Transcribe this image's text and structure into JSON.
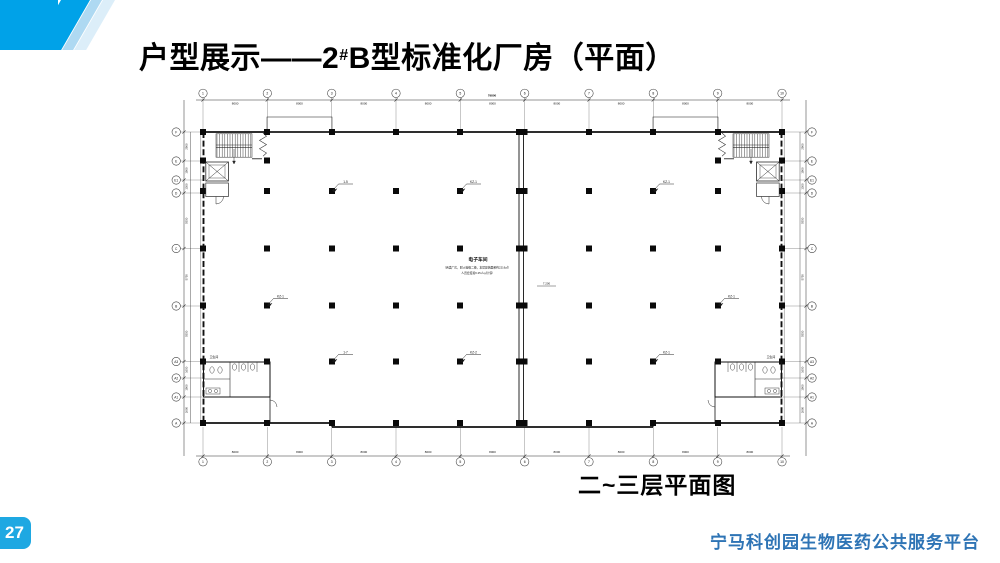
{
  "slide": {
    "title_prefix": "户型展示——2",
    "title_hash": "#",
    "title_suffix": "B型标准化厂房（平面）"
  },
  "caption": "二~三层平面图",
  "footer": {
    "text": "宁马科创园生物医药公共服务平台",
    "page": "27"
  },
  "colors": {
    "header_blue": "#00A2E8",
    "stripe_light": "#AED9F2",
    "stripe_pale": "#DCEEF9",
    "badge_blue": "#1EA8E2",
    "footer_blue": "#2E74B5"
  },
  "plan": {
    "grid_x": [
      203,
      267.3,
      331.7,
      396,
      460.3,
      524.7,
      589,
      653.3,
      717.7,
      782
    ],
    "grid_y": [
      132,
      161,
      180,
      193,
      248.5,
      306,
      361.5,
      378,
      397,
      423
    ],
    "top_labels": [
      "1",
      "2",
      "3",
      "4",
      "5",
      "6",
      "7",
      "8",
      "9",
      "10"
    ],
    "bottom_labels": [
      "1",
      "2",
      "3",
      "4",
      "5",
      "6",
      "7",
      "8",
      "9",
      "10"
    ],
    "left_labels": [
      "F",
      "E",
      "E1",
      "D",
      "C",
      "B",
      "A3",
      "A2",
      "A1",
      "A"
    ],
    "right_labels": [
      "F",
      "E",
      "E1",
      "D",
      "C",
      "B",
      "A3",
      "A2",
      "A1",
      "A"
    ],
    "dims_top": [
      "8000",
      "8000",
      "8000",
      "8000",
      "8000",
      "8000",
      "8000",
      "8000",
      "8000"
    ],
    "dims_bottom": [
      "8000",
      "8000",
      "8000",
      "8000",
      "8000",
      "8000",
      "8000",
      "8000",
      "8000"
    ],
    "dims_left": [
      "2900",
      "1900",
      "1300",
      "5550",
      "5750",
      "5550",
      "1650",
      "1900",
      "2600"
    ],
    "dims_right": [
      "2900",
      "1900",
      "1300",
      "5550",
      "5750",
      "5550",
      "1650",
      "1900",
      "2600"
    ],
    "dims_total": "79800",
    "column_rows": [
      {
        "y": 132,
        "xs": [
          203,
          267,
          332,
          396,
          460,
          519,
          524.5,
          589,
          653,
          718,
          782
        ]
      },
      {
        "y": 160.5,
        "xs": [
          203,
          267,
          718,
          782
        ]
      },
      {
        "y": 191,
        "xs": [
          203,
          267,
          332,
          396,
          460,
          519,
          524.5,
          589,
          653,
          718,
          782
        ]
      },
      {
        "y": 248.5,
        "xs": [
          203,
          267,
          332,
          396,
          460,
          519,
          524.5,
          589,
          653,
          718,
          782
        ]
      },
      {
        "y": 305.5,
        "xs": [
          203,
          267,
          332,
          396,
          460,
          519,
          524.5,
          589,
          653,
          718,
          782
        ]
      },
      {
        "y": 361.5,
        "xs": [
          203,
          267,
          332,
          396,
          460,
          519,
          524.5,
          589,
          653,
          718,
          782
        ]
      },
      {
        "y": 423,
        "xs": [
          203,
          267,
          332,
          396,
          460,
          519,
          524.5,
          589,
          653,
          718,
          782
        ]
      }
    ],
    "flags": [
      {
        "x": 332,
        "y": 191,
        "label": "1-5"
      },
      {
        "x": 460,
        "y": 191,
        "label": "KZ-1"
      },
      {
        "x": 653,
        "y": 191,
        "label": "KZ-1"
      },
      {
        "x": 267,
        "y": 305.5,
        "label": "KZ-1"
      },
      {
        "x": 718,
        "y": 305.5,
        "label": "KZ-1"
      },
      {
        "x": 332,
        "y": 361.5,
        "label": "1-7"
      },
      {
        "x": 460,
        "y": 361.5,
        "label": "KZ-2"
      },
      {
        "x": 653,
        "y": 361.5,
        "label": "KZ-1"
      }
    ],
    "center_text": {
      "heading": "电子车间",
      "note1": "（丙类厂房，耐火等级二级，本层建筑面积约2216㎡）",
      "note2": "人员密度按0.25人/㎡计算"
    },
    "level_mark": "7.200",
    "wc_label": "卫生间"
  }
}
